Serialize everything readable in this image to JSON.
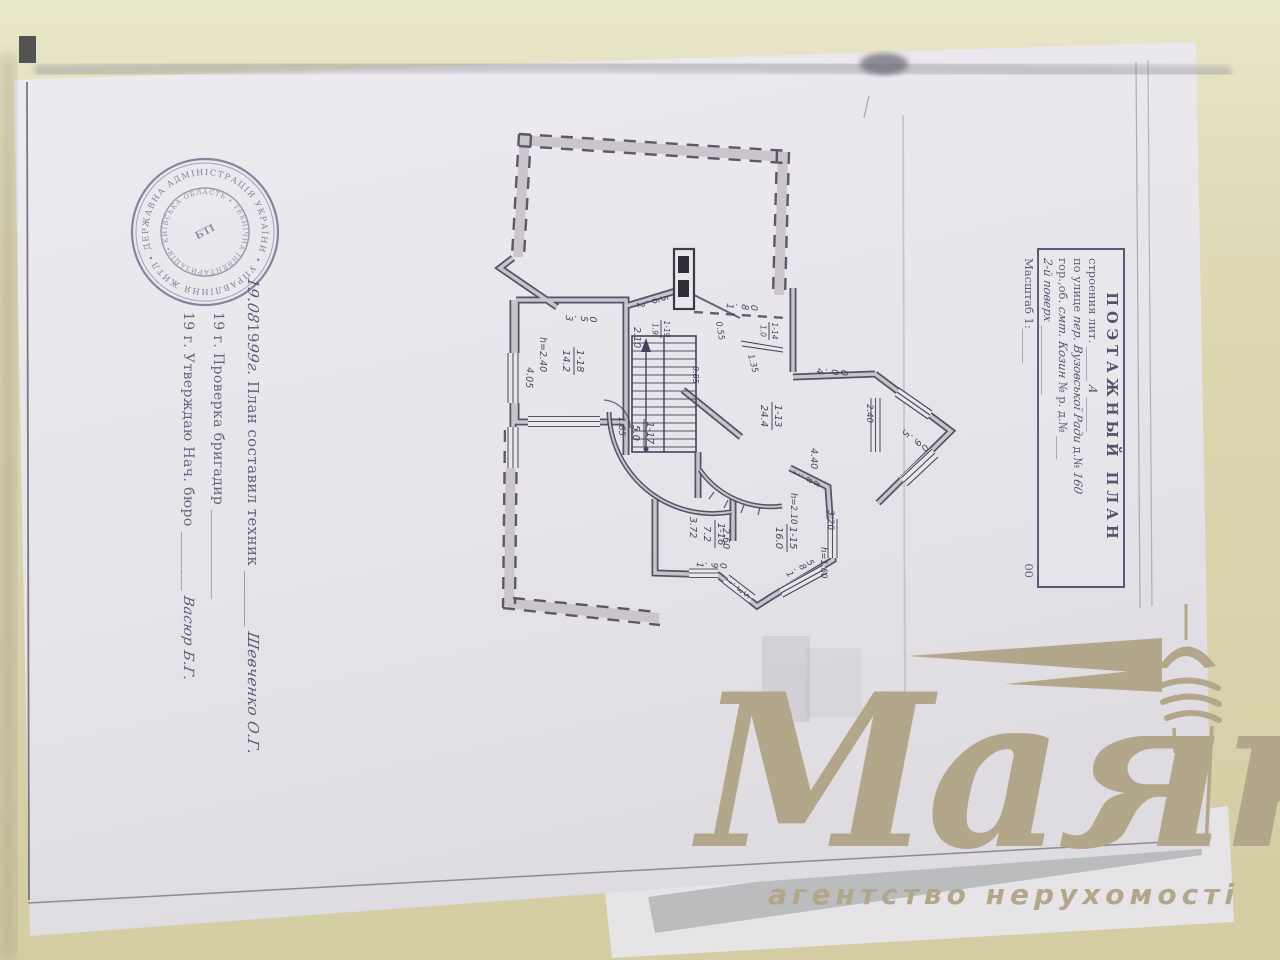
{
  "watermark": {
    "brand": "Маяк",
    "tagline": "агентство нерухомості",
    "color": "#b2a78a"
  },
  "stamp": {
    "outer_ring": "• ДЕРЖАВНА АДМІНІСТРАЦІЯ УКРАЇНИ • УПРАВЛІННЯ ЖИТЛОВО-КОМУНАЛЬНОГО ГОСПОДАРСТВА ",
    "inner_ring": "• КИЇВСЬКА ОБЛАСТЬ • ТЕХНІЧНА ІНВЕНТАРИЗАЦІЯ ",
    "center": "БТІ"
  },
  "annotations": {
    "line1": [
      {
        "s": "hand",
        "t": "19.08 "
      },
      {
        "s": "print",
        "t": "19"
      },
      {
        "s": "hand",
        "t": "99г."
      },
      {
        "s": "print",
        "t": " План составил техник  _______ "
      },
      {
        "s": "hand",
        "t": "Шевченко О.Г."
      }
    ],
    "line2": [
      {
        "s": "print",
        "t": "19      г.   Проверка   бригадир  ____________"
      }
    ],
    "line3": [
      {
        "s": "print",
        "t": "19      г. Утверждаю Нач. бюро  ________ "
      },
      {
        "s": "hand",
        "t": "Васюр Б.Г."
      }
    ]
  },
  "title_block": {
    "title": "ПОЭТАЖНЫЙ ПЛАН",
    "row1": [
      {
        "s": "print",
        "t": "строения лит. ______ "
      },
      {
        "s": "hand",
        "t": "А"
      },
      {
        "s": "print",
        "t": " ______"
      }
    ],
    "row2": [
      {
        "s": "print",
        "t": "по улице "
      },
      {
        "s": "hand",
        "t": "пер. Вузовської Ради"
      },
      {
        "s": "print",
        "t": " д.№ "
      },
      {
        "s": "hand",
        "t": "160"
      }
    ],
    "row3": [
      {
        "s": "print",
        "t": "гор.,об. "
      },
      {
        "s": "hand",
        "t": "смт. Козин"
      },
      {
        "s": "print",
        "t": "  № р. д.№ ____"
      }
    ],
    "row4": [
      {
        "s": "hand",
        "t": "2-й поверх"
      },
      {
        "s": "print",
        "t": " ____________"
      }
    ],
    "row5_left": "Масштаб 1:______",
    "row5_right": "00"
  },
  "floor_plan": {
    "dim_labels": [
      {
        "t": "3.50",
        "x": 566,
        "y": 315,
        "a": 3,
        "g": 90
      },
      {
        "t": "h=2.40",
        "x": 540,
        "y": 337,
        "a": 90,
        "g": 0
      },
      {
        "t": "4.05",
        "x": 527,
        "y": 367,
        "a": 93,
        "g": 0
      },
      {
        "t": "2.10",
        "x": 634,
        "y": 327,
        "a": 90,
        "g": 0
      },
      {
        "t": "2.65",
        "x": 637,
        "y": 303,
        "a": -16,
        "g": 90
      },
      {
        "t": "0.85",
        "x": 693,
        "y": 366,
        "a": 90,
        "g": 0,
        "f": 8
      },
      {
        "t": "1.85",
        "x": 619,
        "y": 417,
        "a": 90,
        "g": 0,
        "f": 8.5
      },
      {
        "t": "1.80",
        "x": 727,
        "y": 303,
        "a": 4,
        "g": 90
      },
      {
        "t": "0.55",
        "x": 716,
        "y": 322,
        "a": 80,
        "g": 0,
        "f": 8.5
      },
      {
        "t": "1.35",
        "x": 748,
        "y": 355,
        "a": 75,
        "g": 0,
        "f": 8.5
      },
      {
        "t": "4.00",
        "x": 817,
        "y": 368,
        "a": 4,
        "g": 90
      },
      {
        "t": "2.40",
        "x": 867,
        "y": 404,
        "a": 90,
        "g": 0,
        "f": 8.5
      },
      {
        "t": "5.90",
        "x": 905,
        "y": 429,
        "a": 37,
        "g": 90
      },
      {
        "t": "4.40",
        "x": 811,
        "y": 448,
        "a": 90,
        "g": 0
      },
      {
        "t": "1.88",
        "x": 795,
        "y": 470,
        "a": 26,
        "g": 90,
        "f": 8.5
      },
      {
        "t": "h=2.10",
        "x": 791,
        "y": 493,
        "a": 90,
        "g": 0,
        "f": 8.5
      },
      {
        "t": "3.20",
        "x": 828,
        "y": 510,
        "a": 90,
        "g": 0,
        "f": 9
      },
      {
        "t": "h=1.60",
        "x": 821,
        "y": 547,
        "a": 90,
        "g": 0,
        "f": 8.5
      },
      {
        "t": "1.85",
        "x": 786,
        "y": 573,
        "a": -29,
        "g": 90,
        "f": 9
      },
      {
        "t": "1.35",
        "x": 728,
        "y": 577,
        "a": 38,
        "g": 90,
        "f": 8.5
      },
      {
        "t": "1.90",
        "x": 697,
        "y": 562,
        "a": 2,
        "g": 90,
        "f": 9
      },
      {
        "t": "3.72",
        "x": 690,
        "y": 517,
        "a": 90,
        "g": 0
      },
      {
        "t": "2.60",
        "x": 723,
        "y": 528,
        "a": 90,
        "g": 0
      }
    ],
    "room_labels": [
      {
        "num": "1-18",
        "area": "14.2",
        "x": 574,
        "y": 361
      },
      {
        "num": "1-19",
        "area": "1.9",
        "x": 661,
        "y": 329,
        "small": true
      },
      {
        "num": "1-14",
        "area": "1.0",
        "x": 769,
        "y": 331,
        "small": true
      },
      {
        "num": "1-17",
        "area": "5.0",
        "x": 644,
        "y": 433
      },
      {
        "num": "1-13",
        "area": "24.4",
        "x": 772,
        "y": 416
      },
      {
        "num": "1-16",
        "area": "7.2",
        "x": 715,
        "y": 534
      },
      {
        "num": "1-15",
        "area": "16.0",
        "x": 787,
        "y": 538
      }
    ]
  }
}
